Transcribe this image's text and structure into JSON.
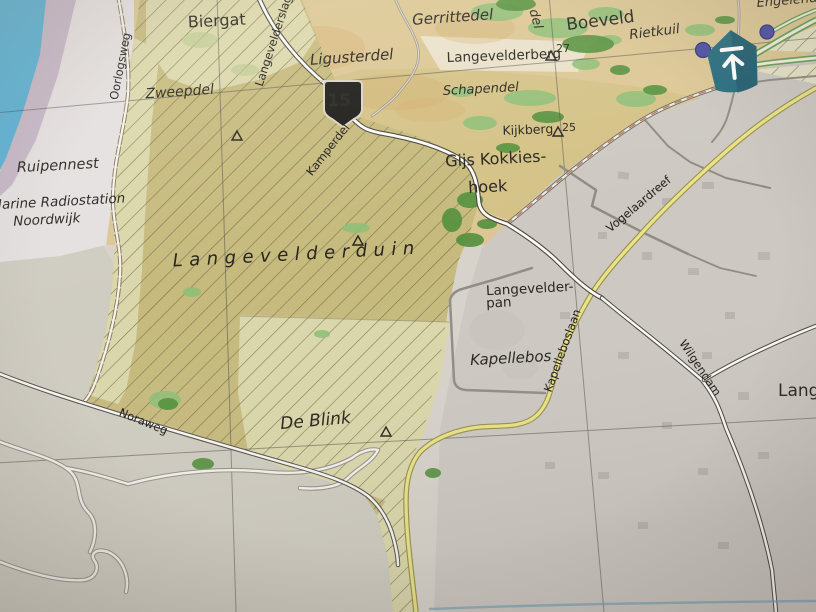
{
  "map": {
    "labels": {
      "biergat": "Biergat",
      "zweepdel": "Zweepdel",
      "ligusterdel": "Ligusterdel",
      "gerrittedel": "Gerrittedel",
      "del_fragment": "del",
      "boeveld": "Boeveld",
      "rietkuil": "Rietkuil",
      "engelendel": "Engelendel",
      "langevelderberg": "Langevelderberg",
      "schapendel": "Schapendel",
      "kijkberg": "Kijkberg",
      "gijs_kokkieshoek_1": "Gijs Kokkies-",
      "gijs_kokkieshoek_2": "hoek",
      "ruipennest": "Ruipennest",
      "marine_1": "Marine Radiostation",
      "marine_2": "Noordwijk",
      "langevelderduin": "Langevelderduin",
      "langevelderpan_1": "Langevelder-",
      "langevelderpan_2": "pan",
      "kapellebos": "Kapellebos",
      "de_blink": "De Blink",
      "lang_cutoff": "Lang"
    },
    "road_labels": {
      "oorlogsweg": "Oorlogsweg",
      "langevelderslag": "Langevelderslag",
      "kamperdel": "Kamperdel",
      "noraweg": "Noraweg",
      "vogelaardreef": "Vogelaardreef",
      "kapelleboslaan": "Kapelleboslaan",
      "wilgendam": "Wilgendam"
    },
    "route_shield": {
      "number": "15"
    },
    "elevations": {
      "langevelderberg": "27",
      "kijkberg": "25"
    },
    "icons": {
      "pin": "up-arrow-location-marker",
      "dots": "poi-dot",
      "triangles": "survey-triangle-marker"
    },
    "colors": {
      "water": "#57b0d4",
      "lavender": "#c4b3c4",
      "dune_olive": "#c6ba7d",
      "dune_pale": "#dbd7ab",
      "sand": "#dcc794",
      "field_olive": "#d3c184",
      "urban": "#cdc8c2",
      "beach": "#cfccc1",
      "road_yellow": "#eae387",
      "forest_dark": "#55913e",
      "forest_light": "#8fbf77",
      "pin_teal": "#276c7e",
      "dot_purple": "#4a4da0"
    }
  }
}
